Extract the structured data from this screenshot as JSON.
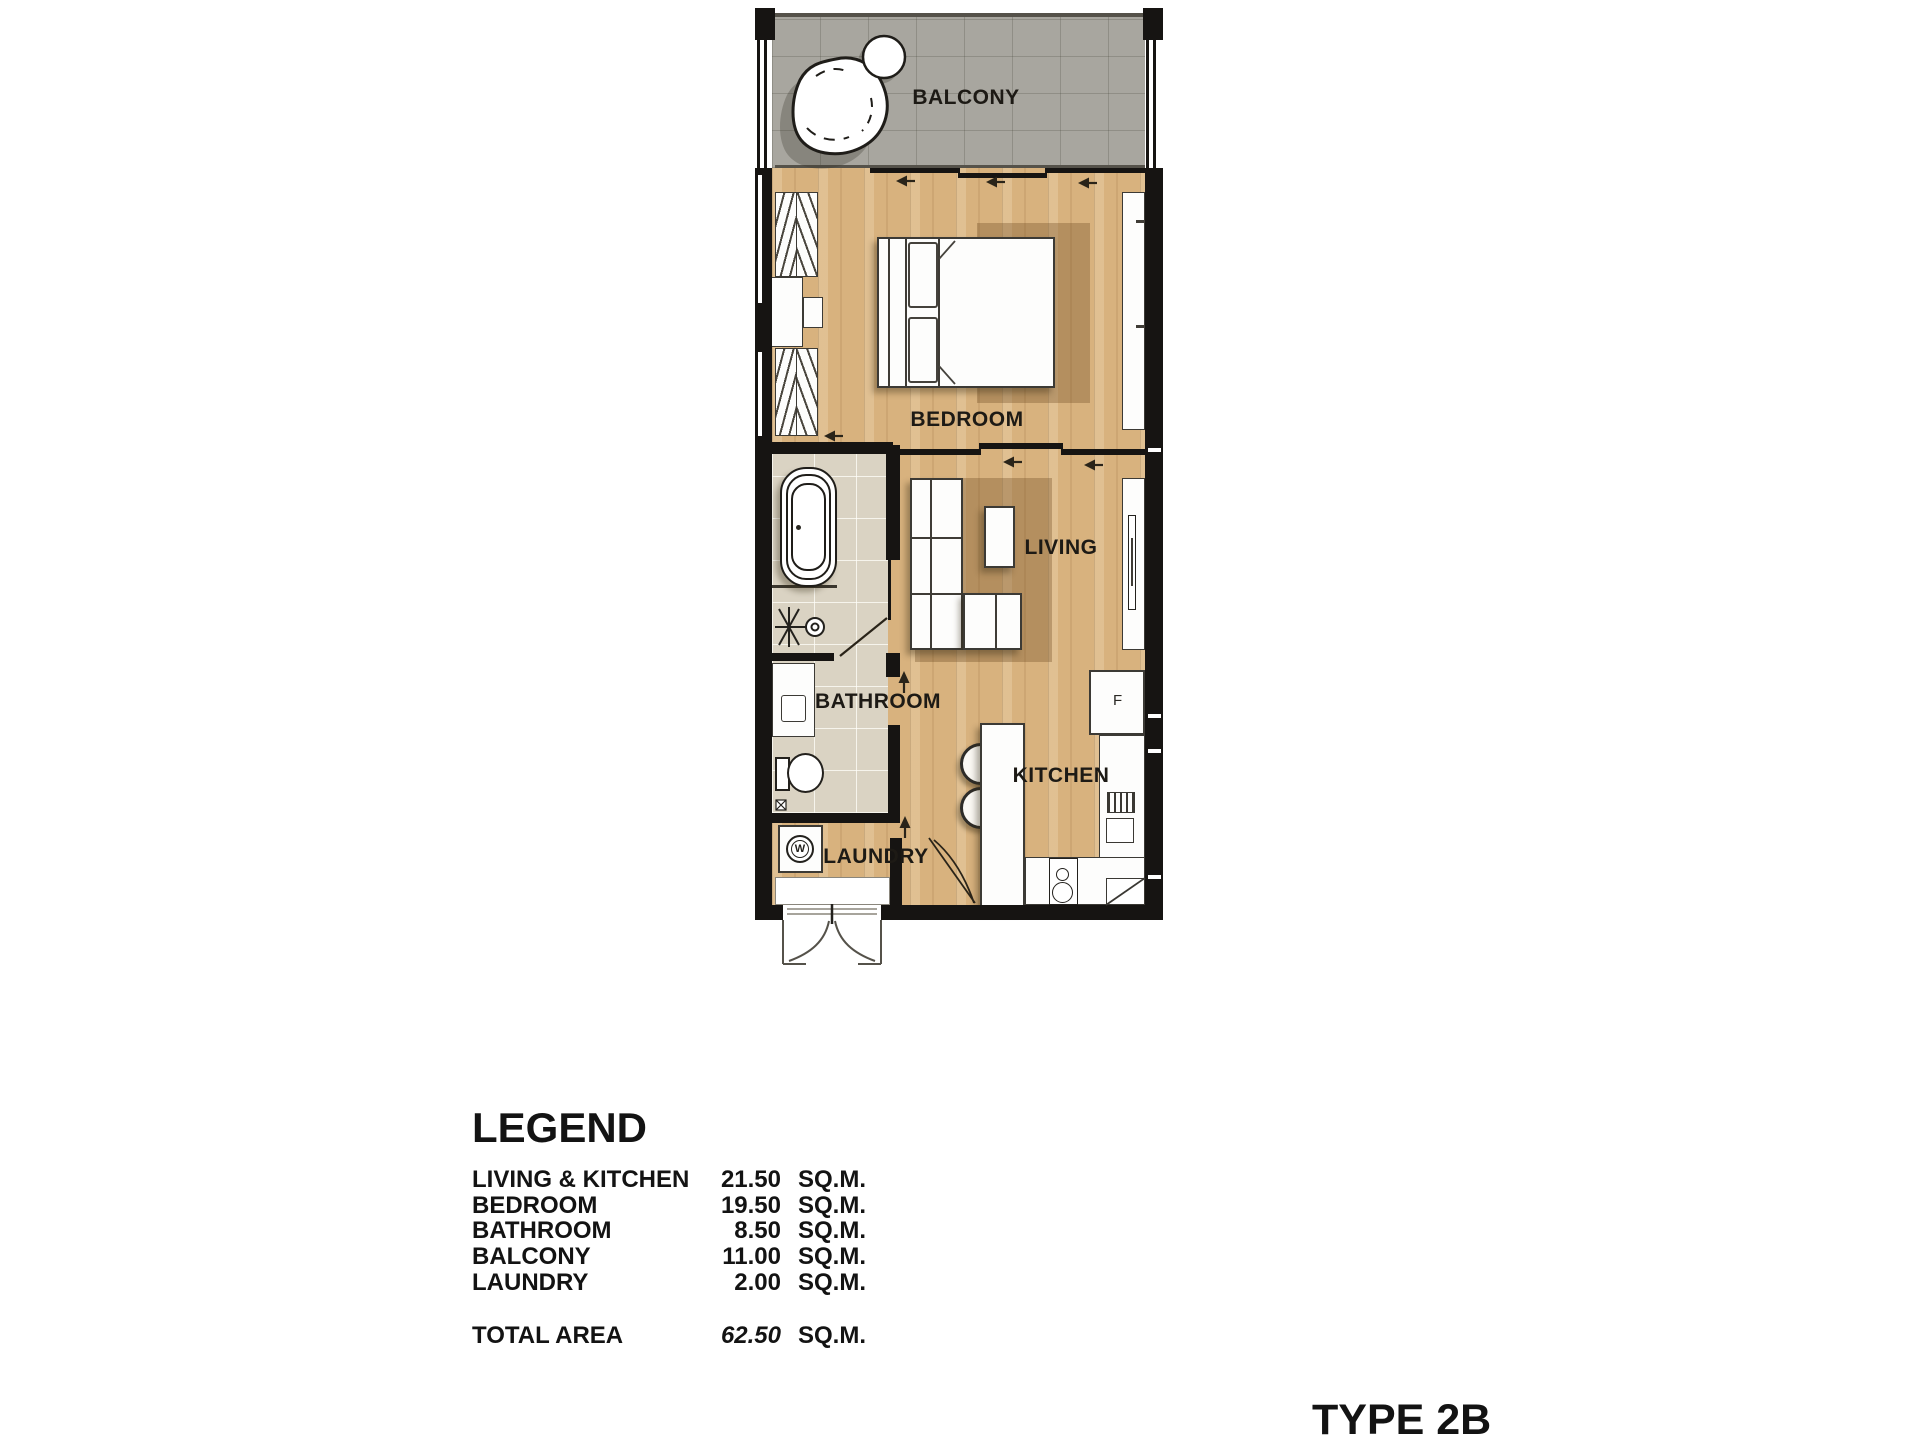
{
  "plan": {
    "rooms": {
      "balcony": "BALCONY",
      "bedroom": "BEDROOM",
      "living": "LIVING",
      "bathroom": "BATHROOM",
      "kitchen": "KITCHEN",
      "laundry": "LAUNDRY"
    },
    "appliances": {
      "fridge": "F",
      "washer": "W"
    },
    "colors": {
      "wood_floor": "#d8b27e",
      "balcony_tile": "#a8a69f",
      "bathroom_tile": "#dad3c3",
      "wall": "#161412",
      "rug": "rgba(110,77,34,0.34)"
    }
  },
  "legend": {
    "title": "LEGEND",
    "rows": [
      {
        "label": "LIVING & KITCHEN",
        "value": "21.50",
        "unit": "SQ.M."
      },
      {
        "label": "BEDROOM",
        "value": "19.50",
        "unit": "SQ.M."
      },
      {
        "label": "BATHROOM",
        "value": "8.50",
        "unit": "SQ.M."
      },
      {
        "label": "BALCONY",
        "value": "11.00",
        "unit": "SQ.M."
      },
      {
        "label": "LAUNDRY",
        "value": "2.00",
        "unit": "SQ.M."
      }
    ],
    "total": {
      "label": "TOTAL AREA",
      "value": "62.50",
      "unit": "SQ.M."
    }
  },
  "unit_type": "TYPE 2B"
}
